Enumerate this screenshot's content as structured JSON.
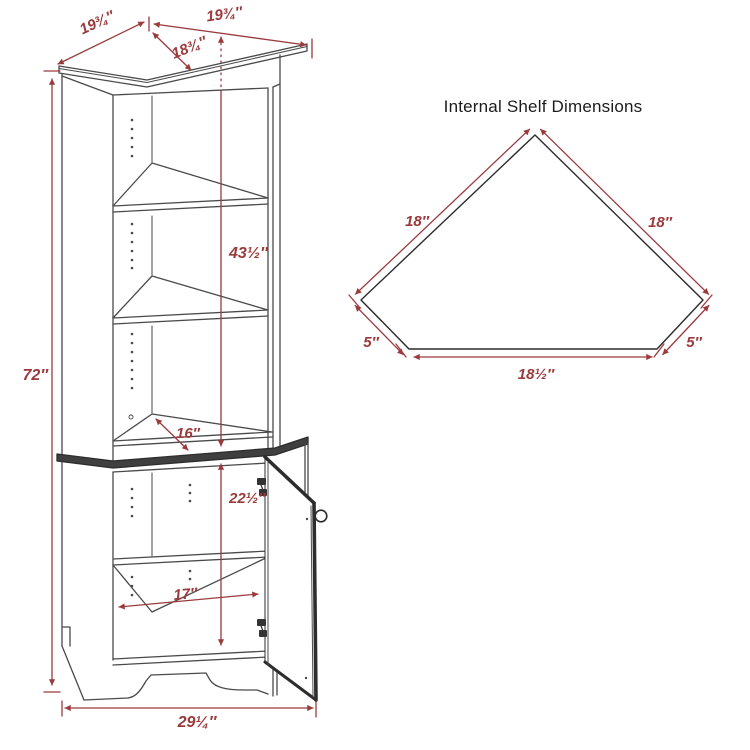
{
  "diagram": {
    "cabinet": {
      "dim_top_left_edge": "19¾″",
      "dim_top_right_edge": "19¾″",
      "dim_top_diagonal": "18¾″",
      "dim_total_height": "72″",
      "dim_upper_interior_height": "43½″",
      "dim_shelf_depth": "16″",
      "dim_lower_interior_height": "22½″",
      "dim_lower_shelf_width": "17″",
      "dim_base_width": "29¼″"
    },
    "shelf_diagram": {
      "title": "Internal Shelf Dimensions",
      "dim_left_edge": "18″",
      "dim_right_edge": "18″",
      "dim_left_corner": "5″",
      "dim_right_corner": "5″",
      "dim_front_edge": "18½″"
    },
    "colors": {
      "dimension": "#9b3a3c",
      "line": "#4a4a4a",
      "thick_line": "#2d2d2d",
      "title_text": "#1c1c1c"
    }
  }
}
